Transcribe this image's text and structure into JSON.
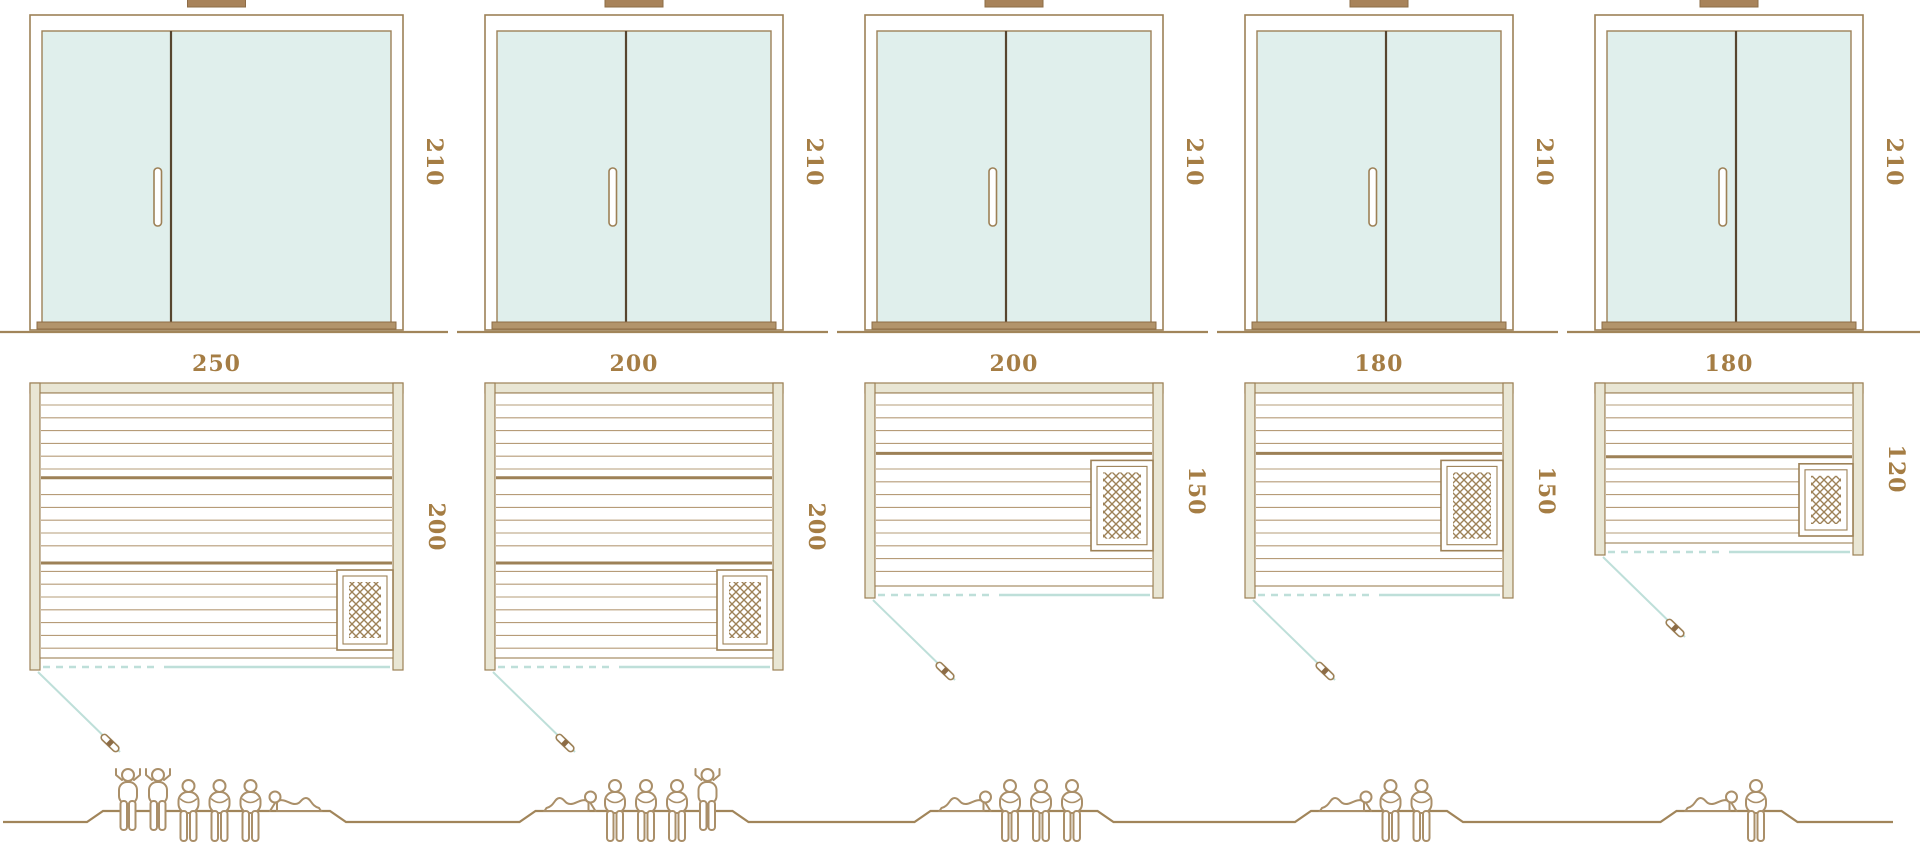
{
  "page": {
    "background": "#ffffff",
    "description": "Size comparison diagram of five sauna cabins: front glass-door elevations with height dimension, floor plans with width and depth dimensions, heater symbol, outward door swing, and capacity figures on a ground line"
  },
  "dimension_unit": "cm",
  "colors": {
    "outline_brown": "#9d8157",
    "light_brown": "#b69c78",
    "dark_brown": "#57452f",
    "dimension_text": "#a57d44",
    "glass_teal": "#e0efec",
    "wall_beige": "#e9e6d4",
    "door_swing_teal": "#bedfd9",
    "figure_brown": "#aa8f69",
    "ground_brown": "#a1855a",
    "threshold_brown": "#b2946b"
  },
  "units": [
    {
      "id": "sauna-250x200",
      "door_height_label": "210",
      "plan_width_label": "250",
      "plan_depth_label": "200",
      "door_height_cm": 210,
      "width_cm": 250,
      "depth_cm": 200,
      "heater_position": "bottom-right",
      "capacity": {
        "total": 6,
        "standing": 2,
        "sitting": 3,
        "lying": 1,
        "arrangement": [
          "standing",
          "standing",
          "sitting",
          "sitting",
          "sitting",
          "lying-right"
        ]
      }
    },
    {
      "id": "sauna-200x200",
      "door_height_label": "210",
      "plan_width_label": "200",
      "plan_depth_label": "200",
      "door_height_cm": 210,
      "width_cm": 200,
      "depth_cm": 200,
      "heater_position": "bottom-right",
      "capacity": {
        "total": 5,
        "standing": 1,
        "sitting": 3,
        "lying": 1,
        "arrangement": [
          "lying-left",
          "sitting",
          "sitting",
          "sitting",
          "standing"
        ]
      }
    },
    {
      "id": "sauna-200x150",
      "door_height_label": "210",
      "plan_width_label": "200",
      "plan_depth_label": "150",
      "door_height_cm": 210,
      "width_cm": 200,
      "depth_cm": 150,
      "heater_position": "middle-right",
      "capacity": {
        "total": 4,
        "standing": 0,
        "sitting": 3,
        "lying": 1,
        "arrangement": [
          "lying-left",
          "sitting",
          "sitting",
          "sitting"
        ]
      }
    },
    {
      "id": "sauna-180x150",
      "door_height_label": "210",
      "plan_width_label": "180",
      "plan_depth_label": "150",
      "door_height_cm": 210,
      "width_cm": 180,
      "depth_cm": 150,
      "heater_position": "middle-right",
      "capacity": {
        "total": 3,
        "standing": 0,
        "sitting": 2,
        "lying": 1,
        "arrangement": [
          "lying-left",
          "sitting",
          "sitting"
        ]
      }
    },
    {
      "id": "sauna-180x120",
      "door_height_label": "210",
      "plan_width_label": "180",
      "plan_depth_label": "120",
      "door_height_cm": 210,
      "width_cm": 180,
      "depth_cm": 120,
      "heater_position": "lower-right",
      "capacity": {
        "total": 2,
        "standing": 0,
        "sitting": 1,
        "lying": 1,
        "arrangement": [
          "lying-left",
          "sitting"
        ]
      }
    }
  ]
}
